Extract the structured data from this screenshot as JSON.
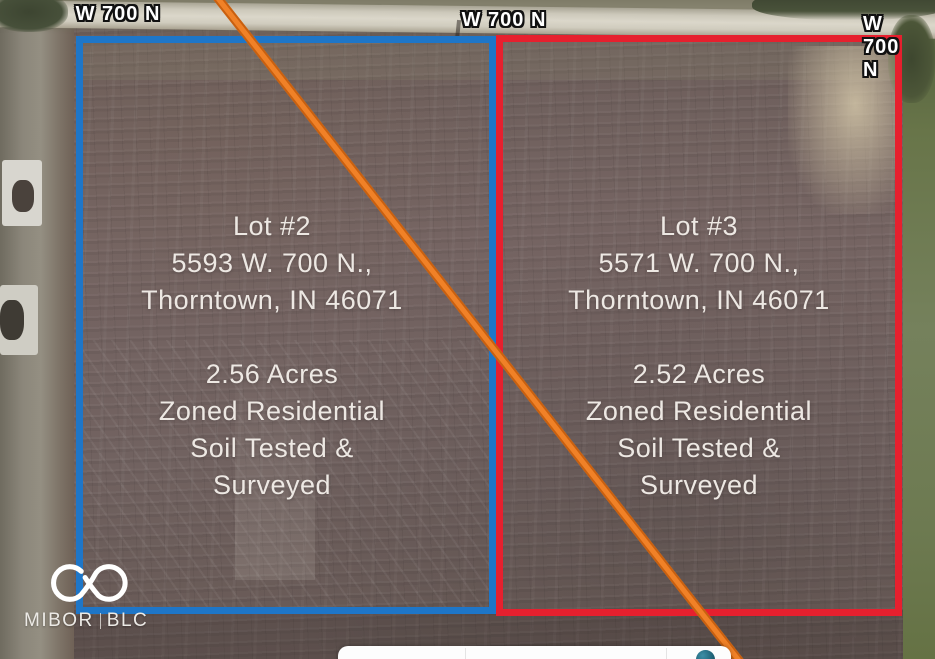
{
  "road": {
    "labels": [
      "W 700 N",
      "W 700 N",
      "W 700 N"
    ]
  },
  "lots": [
    {
      "name": "Lot #2",
      "address1": "5593 W. 700 N.,",
      "address2": "Thorntown, IN 46071",
      "acreage": "2.56 Acres",
      "zoning": "Zoned Residential",
      "note1": "Soil Tested &",
      "note2": "Surveyed",
      "outline_color": "#1e76c8"
    },
    {
      "name": "Lot #3",
      "address1": "5571 W. 700 N.,",
      "address2": "Thorntown, IN 46071",
      "acreage": "2.52 Acres",
      "zoning": "Zoned Residential",
      "note1": "Soil Tested &",
      "note2": "Surveyed",
      "outline_color": "#e6202e"
    }
  ],
  "watermark": {
    "brand": "MIBOR",
    "suffix": "BLC",
    "logo_icon": "infinity-icon"
  },
  "overlay": {
    "survey_line_color": "#f08127",
    "toolbar_icon": "circle-icon"
  }
}
